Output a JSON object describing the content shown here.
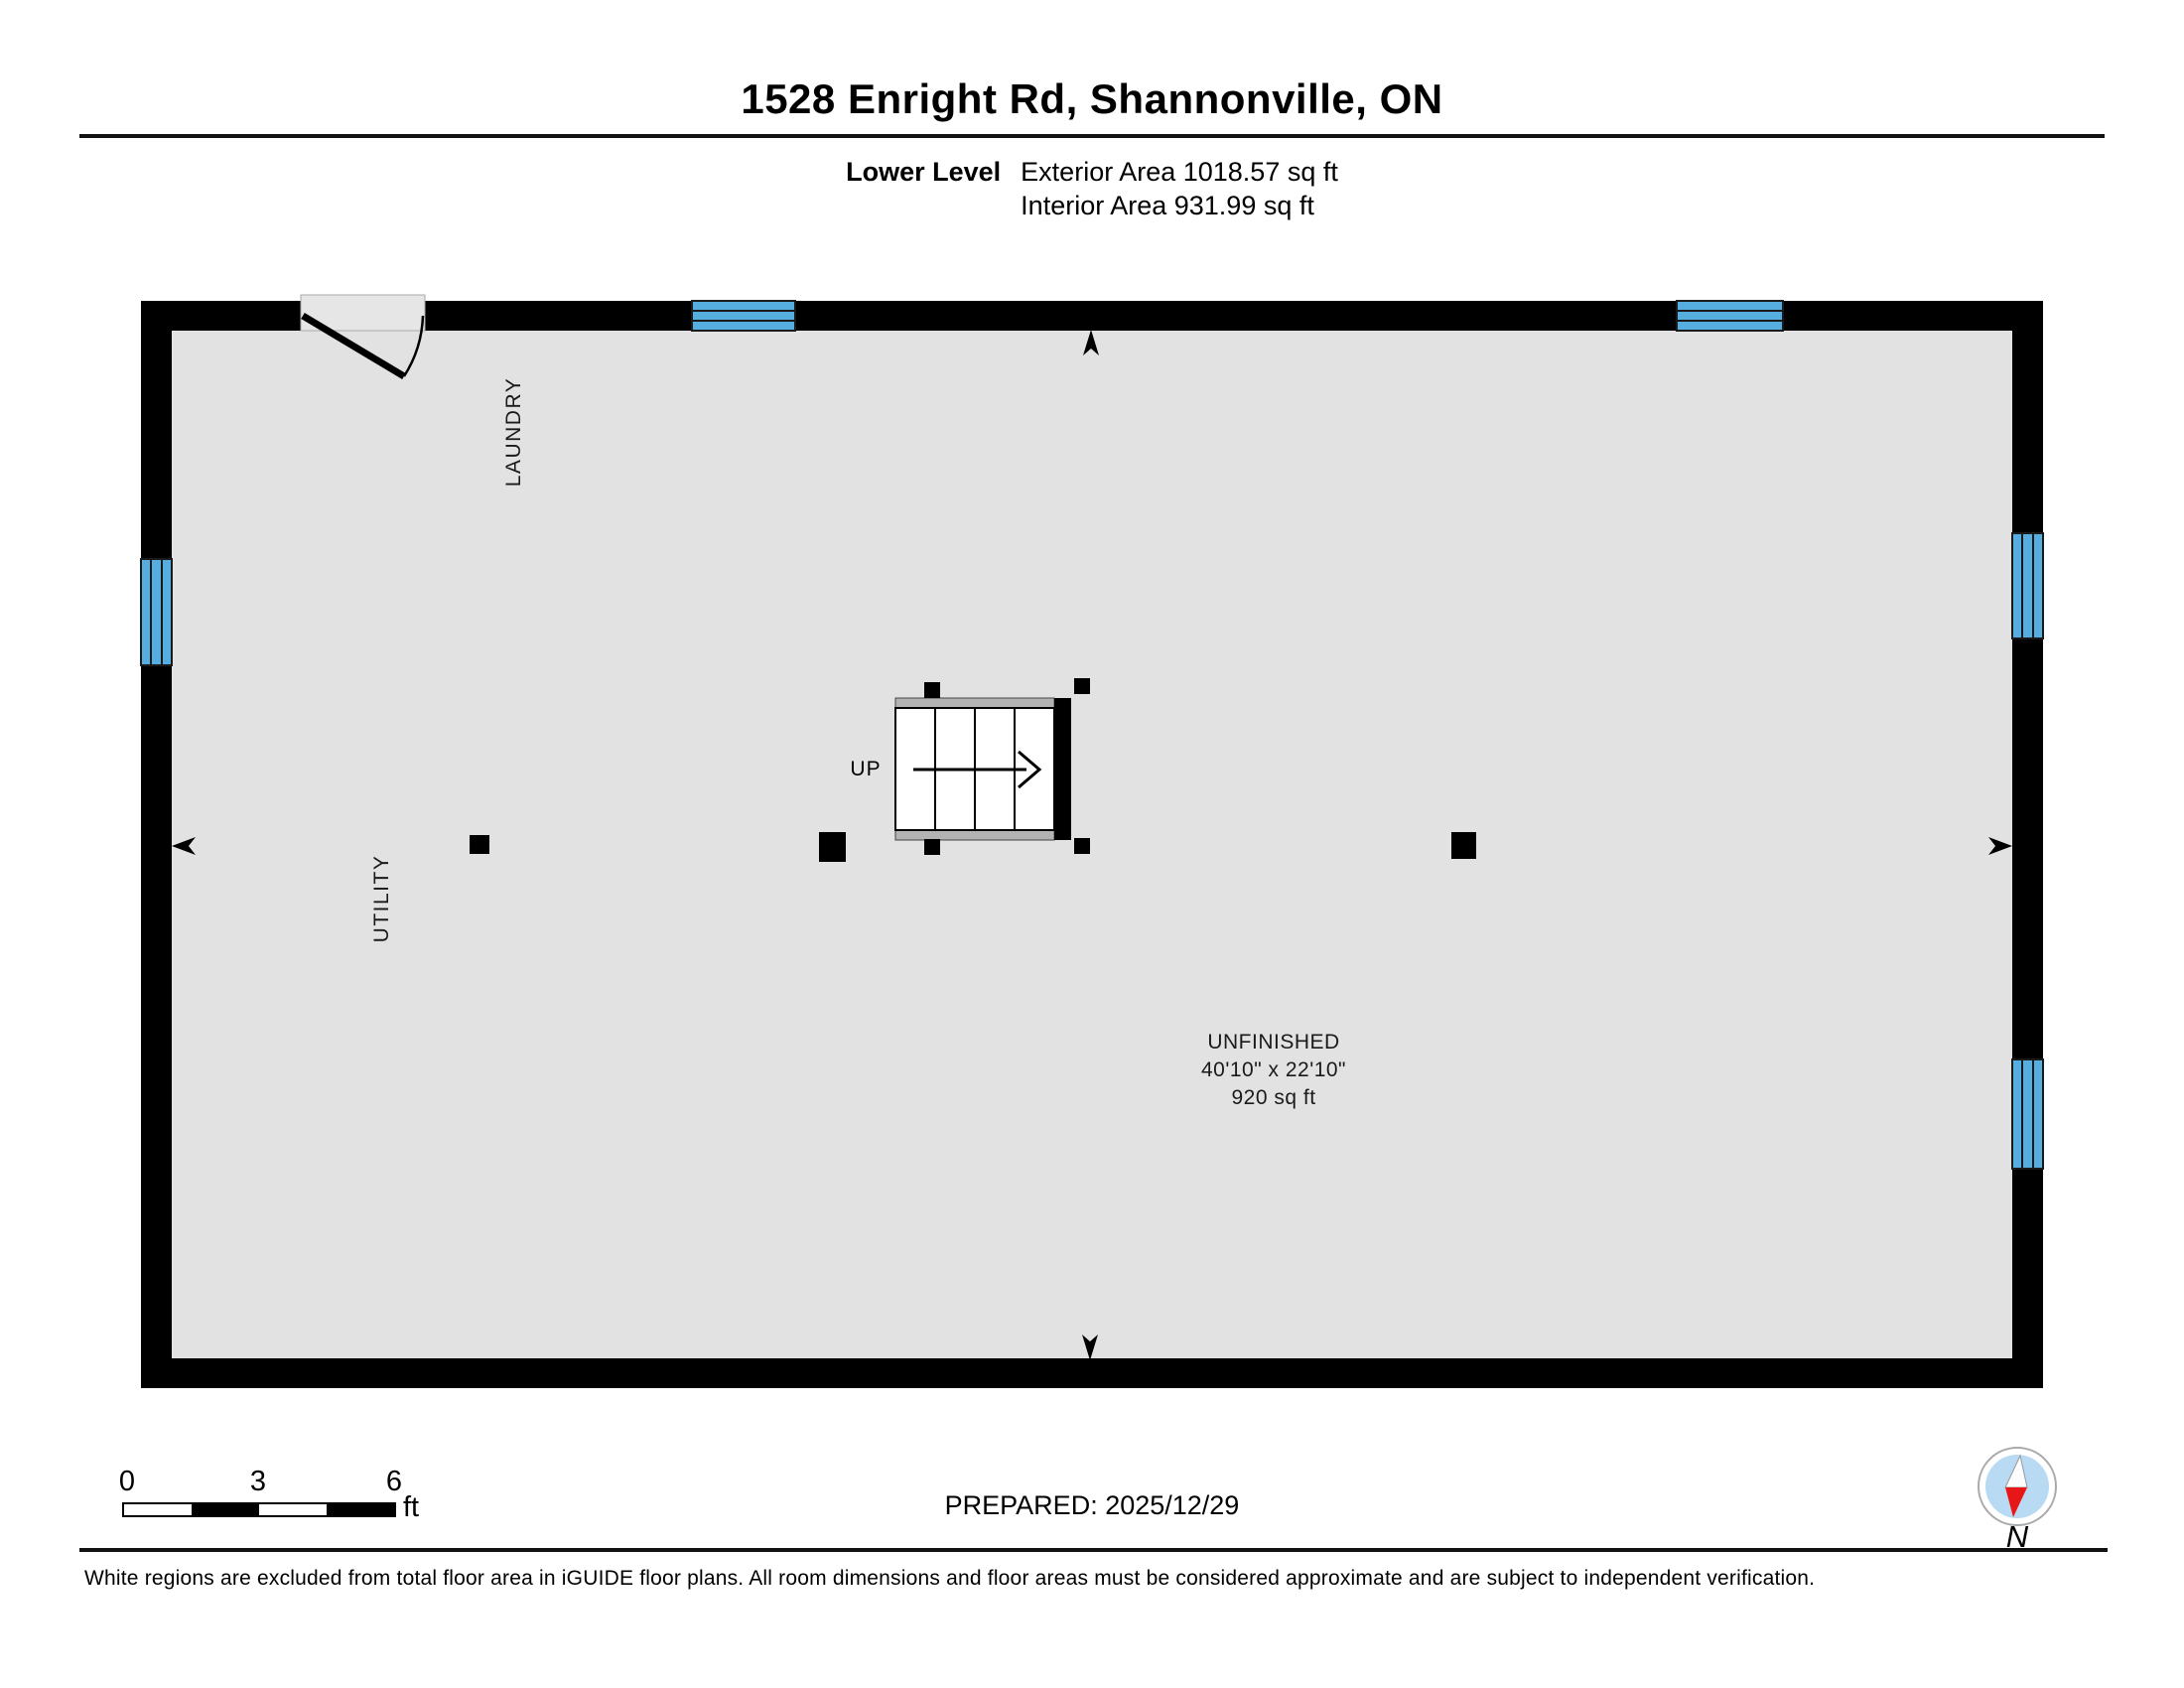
{
  "header": {
    "title": "1528 Enright Rd, Shannonville, ON",
    "level_label": "Lower Level",
    "exterior_area": "Exterior Area 1018.57 sq ft",
    "interior_area": "Interior Area 931.99 sq ft"
  },
  "plan": {
    "labels": {
      "laundry": "LAUNDRY",
      "utility": "UTILITY",
      "up": "UP",
      "unfinished_name": "UNFINISHED",
      "unfinished_dims": "40'10\" x 22'10\"",
      "unfinished_area": "920 sq ft"
    }
  },
  "footer": {
    "scale_ticks": [
      "0",
      "3",
      "6"
    ],
    "scale_unit": "ft",
    "prepared": "PREPARED: 2025/12/29",
    "compass_label": "N",
    "disclaimer": "White regions are excluded from total floor area in iGUIDE floor plans. All room dimensions and floor areas must be considered approximate and are subject to independent verification."
  },
  "colors": {
    "wall": "#000000",
    "floor": "#e2e2e2",
    "window": "#56aee0",
    "stair_strip": "#b3b3b3",
    "door_fill": "#e6e6e6",
    "compass_ring": "#ffffff",
    "compass_blue": "#b8daf2",
    "compass_red": "#e81717"
  }
}
